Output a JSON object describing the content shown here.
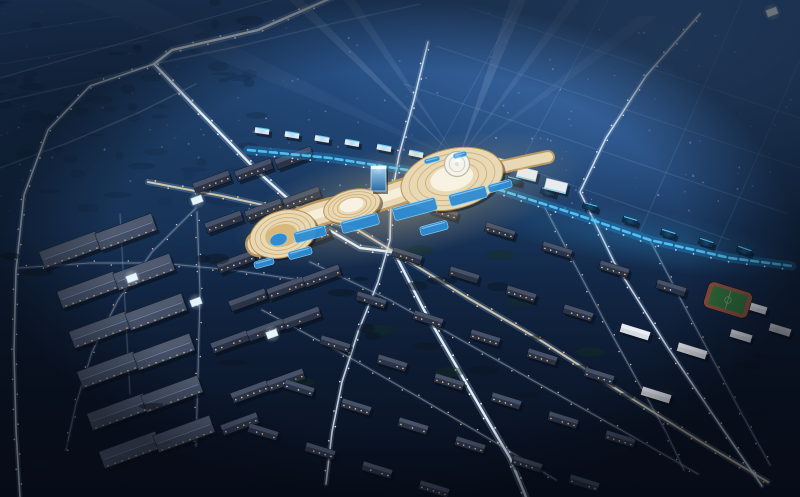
{
  "scene": {
    "viewBox": "0 0 800 497",
    "description": "Night-time aerial architectural rendering of a planned city district: a flowing illuminated mall complex with terraced cream roofs and blue pools at center, searchlight beams, a blue-lit commercial avenue, industrial warehouses lower-left, residential apartment grid lower-right with a sports field, and hazy blue distant city above",
    "palette": {
      "skyTop": "#2e5a94",
      "skyUpper": "#1f4370",
      "skyMid": "#142c4e",
      "skyBottom": "#0a1322",
      "skyNE": "#4273b2",
      "skyTLdark": "#152c49",
      "speckle": "#0e2136",
      "groundDark": "#081020",
      "vignette": "#05080f",
      "roadGlow": "#9fc0e0",
      "roadCore": "#eef4fb",
      "roadWarm": "#e8d8b4",
      "dimCore": "#c9cfe0",
      "dotWhite": "#f5f9ff",
      "dotWarm": "#ffd9a0",
      "dotBlue": "#cfeaff",
      "blueBand": "#1f86c8",
      "blueCore": "#5ad0ff",
      "blueGlow": "#38a8e8",
      "mallCream": "#e8d8b4",
      "mallEdge": "#b8904e",
      "mallRing": "#c8a060",
      "mallTop": "#f7f2e2",
      "mallGlow": "#ffd98f",
      "discFill": "#f4f4ec",
      "discRing": "#b8b8ac",
      "poolFill": "#2e8cd4",
      "poolEdge": "#86d4f8",
      "courtGold": "#d9b87c",
      "glassTop": "#a8d8f4",
      "glassBot": "#2a6aa0",
      "glassEdge": "#cfe8f8",
      "warehouseRoof": "#434f66",
      "ridge": "#93a6c4",
      "windowWarm": "#ffc878",
      "windowCool": "#cfe4ff",
      "slabRoof": "#6b7890",
      "slabDark": "#2a3347",
      "slabLight": "#d5dde8",
      "stripBoxDark": "#10304e",
      "stripBoxWhite": "#dfe9f2",
      "commercialWhite": "#e6edf4",
      "fieldGreen": "#2f6c38",
      "track": "#8a5040",
      "fieldLine": "#cfe0d0",
      "tree": "#0b1622",
      "green": "#15301f",
      "shadow": "#060b14",
      "pavilion": "#e8f4fc",
      "beam": "#dcebff",
      "flare": "#ffffff"
    },
    "road_styles": {
      "bright": {
        "glowW": 7,
        "glowOp": 0.3,
        "coreW": 2.4,
        "coreOp": 0.95,
        "spacing": 14,
        "dotR": 0.95,
        "dot": "dotWhite",
        "core": "roadCore",
        "glow": "roadGlow"
      },
      "medium": {
        "glowW": 5,
        "glowOp": 0.22,
        "coreW": 1.6,
        "coreOp": 0.8,
        "spacing": 15,
        "dotR": 0.85,
        "dot": "dotWhite",
        "core": "roadCore",
        "glow": "roadGlow"
      },
      "warm": {
        "glowW": 6,
        "glowOp": 0.25,
        "coreW": 2.0,
        "coreOp": 0.85,
        "spacing": 14,
        "dotR": 0.9,
        "dot": "dotWarm",
        "core": "roadWarm",
        "glow": "roadGlow"
      },
      "dim": {
        "glowW": 3.5,
        "glowOp": 0.12,
        "coreW": 1.1,
        "coreOp": 0.4,
        "spacing": 17,
        "dotR": 0.75,
        "dot": "dotWarm",
        "core": "dimCore",
        "glow": "roadGlow"
      },
      "faint": {
        "glowW": 2.5,
        "glowOp": 0.08,
        "coreW": 0.9,
        "coreOp": 0.22,
        "spacing": 0,
        "dotR": 0,
        "dot": "dotBlue",
        "core": "dimCore",
        "glow": "roadGlow"
      }
    },
    "roads": [
      {
        "name": "highway-northwest",
        "style": "bright",
        "pts": [
          [
            345,
            -8
          ],
          [
            258,
            30
          ],
          [
            172,
            50
          ],
          [
            154,
            64
          ],
          [
            200,
            112
          ],
          [
            258,
            172
          ],
          [
            312,
            220
          ],
          [
            360,
            248
          ],
          [
            392,
            252
          ]
        ]
      },
      {
        "name": "cross-road-north-south",
        "style": "medium",
        "pts": [
          [
            428,
            42
          ],
          [
            414,
            100
          ],
          [
            399,
            155
          ],
          [
            391,
            200
          ],
          [
            390,
            240
          ],
          [
            378,
            282
          ],
          [
            358,
            332
          ],
          [
            342,
            382
          ],
          [
            332,
            432
          ],
          [
            326,
            484
          ]
        ]
      },
      {
        "name": "south-artery",
        "style": "warm",
        "pts": [
          [
            148,
            182
          ],
          [
            222,
            196
          ],
          [
            300,
            213
          ],
          [
            358,
            230
          ],
          [
            394,
            252
          ],
          [
            468,
            298
          ],
          [
            540,
            340
          ],
          [
            618,
            390
          ],
          [
            698,
            440
          ],
          [
            768,
            482
          ]
        ]
      },
      {
        "name": "southeast-road",
        "style": "bright",
        "pts": [
          [
            394,
            252
          ],
          [
            424,
            310
          ],
          [
            454,
            362
          ],
          [
            484,
            414
          ],
          [
            510,
            458
          ],
          [
            526,
            497
          ]
        ]
      },
      {
        "name": "northeast-road",
        "style": "medium",
        "pts": [
          [
            700,
            14
          ],
          [
            646,
            76
          ],
          [
            606,
            138
          ],
          [
            580,
            192
          ],
          [
            614,
            262
          ],
          [
            668,
            348
          ],
          [
            722,
            428
          ],
          [
            762,
            486
          ]
        ]
      },
      {
        "name": "upper-ridge-road",
        "style": "faint",
        "pts": [
          [
            154,
            64
          ],
          [
            240,
            46
          ],
          [
            330,
            24
          ],
          [
            420,
            4
          ]
        ]
      },
      {
        "name": "upper-left-road",
        "style": "faint",
        "pts": [
          [
            0,
            102
          ],
          [
            80,
            84
          ],
          [
            154,
            64
          ]
        ]
      },
      {
        "name": "upper-left-road-2",
        "style": "faint",
        "pts": [
          [
            0,
            168
          ],
          [
            70,
            142
          ],
          [
            140,
            112
          ],
          [
            196,
            84
          ]
        ]
      },
      {
        "name": "industrial-edge-road",
        "style": "dim",
        "pts": [
          [
            196,
            208
          ],
          [
            152,
            252
          ],
          [
            118,
            300
          ],
          [
            92,
            352
          ],
          [
            76,
            404
          ],
          [
            66,
            450
          ]
        ]
      },
      {
        "name": "industrial-street-h",
        "style": "dim",
        "pts": [
          [
            18,
            268
          ],
          [
            90,
            263
          ],
          [
            160,
            263
          ],
          [
            232,
            270
          ],
          [
            300,
            280
          ]
        ]
      },
      {
        "name": "industrial-street-v1",
        "style": "dim",
        "pts": [
          [
            197,
            212
          ],
          [
            200,
            292
          ],
          [
            198,
            372
          ],
          [
            196,
            446
          ]
        ]
      },
      {
        "name": "industrial-street-v2",
        "style": "faint",
        "pts": [
          [
            120,
            214
          ],
          [
            125,
            304
          ],
          [
            130,
            394
          ]
        ]
      },
      {
        "name": "left-loop-road",
        "style": "medium",
        "pts": [
          [
            154,
            64
          ],
          [
            90,
            86
          ],
          [
            48,
            130
          ],
          [
            24,
            195
          ],
          [
            16,
            270
          ],
          [
            14,
            350
          ],
          [
            16,
            430
          ],
          [
            20,
            497
          ]
        ]
      },
      {
        "name": "residential-street-1",
        "style": "dim",
        "pts": [
          [
            310,
            262
          ],
          [
            390,
            300
          ],
          [
            470,
            345
          ],
          [
            550,
            390
          ],
          [
            630,
            435
          ],
          [
            698,
            474
          ]
        ]
      },
      {
        "name": "residential-street-2",
        "style": "dim",
        "pts": [
          [
            262,
            310
          ],
          [
            340,
            352
          ],
          [
            420,
            398
          ],
          [
            498,
            444
          ],
          [
            556,
            480
          ]
        ]
      },
      {
        "name": "residential-cross-1",
        "style": "dim",
        "pts": [
          [
            545,
            208
          ],
          [
            575,
            265
          ],
          [
            605,
            322
          ],
          [
            637,
            380
          ],
          [
            666,
            432
          ],
          [
            684,
            470
          ]
        ]
      },
      {
        "name": "residential-cross-2",
        "style": "dim",
        "pts": [
          [
            650,
            240
          ],
          [
            680,
            298
          ],
          [
            711,
            356
          ],
          [
            743,
            416
          ],
          [
            770,
            465
          ]
        ]
      }
    ],
    "blue_avenue": {
      "pts": [
        [
          248,
          150
        ],
        [
          330,
          158
        ],
        [
          420,
          172
        ],
        [
          500,
          190
        ],
        [
          575,
          214
        ],
        [
          650,
          240
        ],
        [
          730,
          258
        ],
        [
          792,
          266
        ]
      ]
    },
    "distant_grid": [
      [
        [
          520,
          0
        ],
        [
          430,
          164
        ]
      ],
      [
        [
          608,
          0
        ],
        [
          504,
          194
        ]
      ],
      [
        [
          742,
          0
        ],
        [
          640,
          232
        ]
      ],
      [
        [
          800,
          60
        ],
        [
          716,
          250
        ]
      ],
      [
        [
          470,
          8
        ],
        [
          800,
          118
        ]
      ],
      [
        [
          436,
          46
        ],
        [
          800,
          168
        ]
      ],
      [
        [
          404,
          84
        ],
        [
          788,
          214
        ]
      ],
      [
        [
          500,
          160
        ],
        [
          730,
          240
        ]
      ],
      [
        [
          0,
          64
        ],
        [
          150,
          40
        ]
      ],
      [
        [
          0,
          34
        ],
        [
          120,
          16
        ]
      ]
    ],
    "streak": [
      [
        0,
        78
      ],
      [
        272,
        0
      ]
    ],
    "beams": {
      "apex": [
        458,
        160
      ],
      "rays": [
        {
          "e": [
            296,
            0
          ],
          "w": 14,
          "o": 0.12
        },
        {
          "e": [
            350,
            0
          ],
          "w": 11,
          "o": 0.09
        },
        {
          "e": [
            518,
            0
          ],
          "w": 16,
          "o": 0.13
        },
        {
          "e": [
            574,
            0
          ],
          "w": 12,
          "o": 0.09
        },
        {
          "e": [
            648,
            16
          ],
          "w": 20,
          "o": 0.06
        },
        {
          "e": [
            110,
            0
          ],
          "w": 70,
          "o": 0.04
        }
      ]
    },
    "scatter": {
      "seed": 7,
      "count": 150,
      "x": [
        0,
        800
      ],
      "y": [
        12,
        212
      ],
      "rMin": 0.5,
      "rMax": 1.1,
      "oMin": 0.12,
      "oMax": 0.4
    },
    "speckles": {
      "seed": 11,
      "count": 60,
      "x": [
        0,
        270
      ],
      "y": [
        0,
        210
      ]
    },
    "trees": {
      "seed": 23,
      "count": 30,
      "x": [
        10,
        770
      ],
      "y": [
        250,
        492
      ]
    },
    "greens": [
      [
        380,
        330
      ],
      [
        450,
        372
      ],
      [
        520,
        302
      ],
      [
        300,
        382
      ],
      [
        590,
        352
      ],
      [
        660,
        394
      ],
      [
        420,
        250
      ],
      [
        500,
        255
      ]
    ],
    "warehouses": [
      [
        70,
        250
      ],
      [
        126,
        232
      ],
      [
        88,
        290
      ],
      [
        144,
        272
      ],
      [
        100,
        330
      ],
      [
        156,
        312
      ],
      [
        108,
        370
      ],
      [
        164,
        352
      ],
      [
        118,
        412
      ],
      [
        172,
        394
      ],
      [
        130,
        450
      ],
      [
        184,
        434
      ]
    ],
    "warehouse_size": [
      60,
      18
    ],
    "warehouse_rot": -20,
    "slabs_warm": [
      [
        212,
        182
      ],
      [
        254,
        170
      ],
      [
        294,
        158
      ],
      [
        224,
        222
      ],
      [
        264,
        210
      ],
      [
        302,
        198
      ],
      [
        236,
        262
      ],
      [
        274,
        250
      ],
      [
        312,
        238
      ],
      [
        248,
        300
      ],
      [
        286,
        288
      ],
      [
        322,
        276
      ],
      [
        230,
        342
      ],
      [
        266,
        330
      ],
      [
        302,
        318
      ],
      [
        250,
        392
      ],
      [
        286,
        380
      ],
      [
        240,
        424
      ]
    ],
    "slab_warm_size": [
      38,
      11
    ],
    "slab_warm_rot": -20,
    "residential_grid": {
      "origin": [
        443,
        212
      ],
      "u": [
        57,
        19
      ],
      "v": [
        -36,
        44
      ],
      "cols": 6,
      "rows": 6,
      "size": [
        30,
        9
      ],
      "rot": 17,
      "skip": [
        [
          0,
          5
        ],
        [
          5,
          4
        ],
        [
          5,
          5
        ]
      ],
      "white": [
        [
          1,
          5
        ],
        [
          2,
          5
        ],
        [
          1,
          4
        ]
      ]
    },
    "white_slabs": [
      [
        756,
        308
      ],
      [
        780,
        330
      ],
      [
        741,
        336
      ]
    ],
    "field": {
      "c": [
        728,
        300
      ],
      "size": [
        46,
        27
      ],
      "rot": 17
    },
    "pavilions": [
      [
        197,
        200
      ],
      [
        132,
        278
      ],
      [
        272,
        334
      ],
      [
        196,
        302
      ],
      [
        772,
        12
      ]
    ],
    "strip_boxes": [
      [
        262,
        140
      ],
      [
        292,
        144
      ],
      [
        322,
        148
      ],
      [
        352,
        152
      ],
      [
        384,
        157
      ],
      [
        416,
        163
      ],
      [
        448,
        172
      ],
      [
        480,
        180
      ],
      [
        514,
        190
      ],
      [
        548,
        201
      ],
      [
        590,
        216
      ],
      [
        630,
        230
      ],
      [
        668,
        243
      ],
      [
        706,
        252
      ],
      [
        744,
        260
      ]
    ],
    "commercial_white": [
      [
        498,
        164,
        22,
        12
      ],
      [
        527,
        174,
        20,
        11
      ],
      [
        556,
        186,
        22,
        11
      ]
    ],
    "mall": {
      "glow": {
        "c": [
          410,
          200
        ],
        "rx": 180,
        "ry": 58,
        "rot": -13
      },
      "blueGlow": {
        "c": [
          640,
          238
        ],
        "rx": 160,
        "ry": 30,
        "rot": 9
      },
      "ribbon": "M258,244 C300,216 326,210 352,206 C390,198 414,184 452,179",
      "tail": "M452,178 C498,168 522,162 548,157",
      "lobes": [
        {
          "name": "west-pod",
          "c": [
            283,
            234
          ],
          "rx": 34,
          "ry": 23,
          "rot": -18,
          "rings": 3,
          "court": true
        },
        {
          "name": "middle-pod",
          "c": [
            352,
            206
          ],
          "rx": 29,
          "ry": 16,
          "rot": -15,
          "rings": 3,
          "court": false
        },
        {
          "name": "main-pod",
          "c": [
            452,
            179
          ],
          "rx": 52,
          "ry": 30,
          "rot": -14,
          "rings": 4,
          "court": false,
          "disc": {
            "c": [
              457,
              164
            ],
            "r": 12.5
          }
        }
      ],
      "pools": [
        [
          310,
          234,
          32,
          11
        ],
        [
          360,
          223,
          38,
          12
        ],
        [
          415,
          209,
          44,
          13
        ],
        [
          468,
          196,
          38,
          12
        ],
        [
          300,
          253,
          24,
          8
        ],
        [
          264,
          263,
          20,
          7
        ],
        [
          434,
          228,
          28,
          9
        ],
        [
          500,
          186,
          24,
          8
        ],
        [
          432,
          160,
          16,
          5
        ],
        [
          460,
          155,
          14,
          5
        ]
      ],
      "pool_rot": -15,
      "tower": {
        "x": 371,
        "y": 166,
        "w": 15,
        "h": 25
      }
    }
  }
}
